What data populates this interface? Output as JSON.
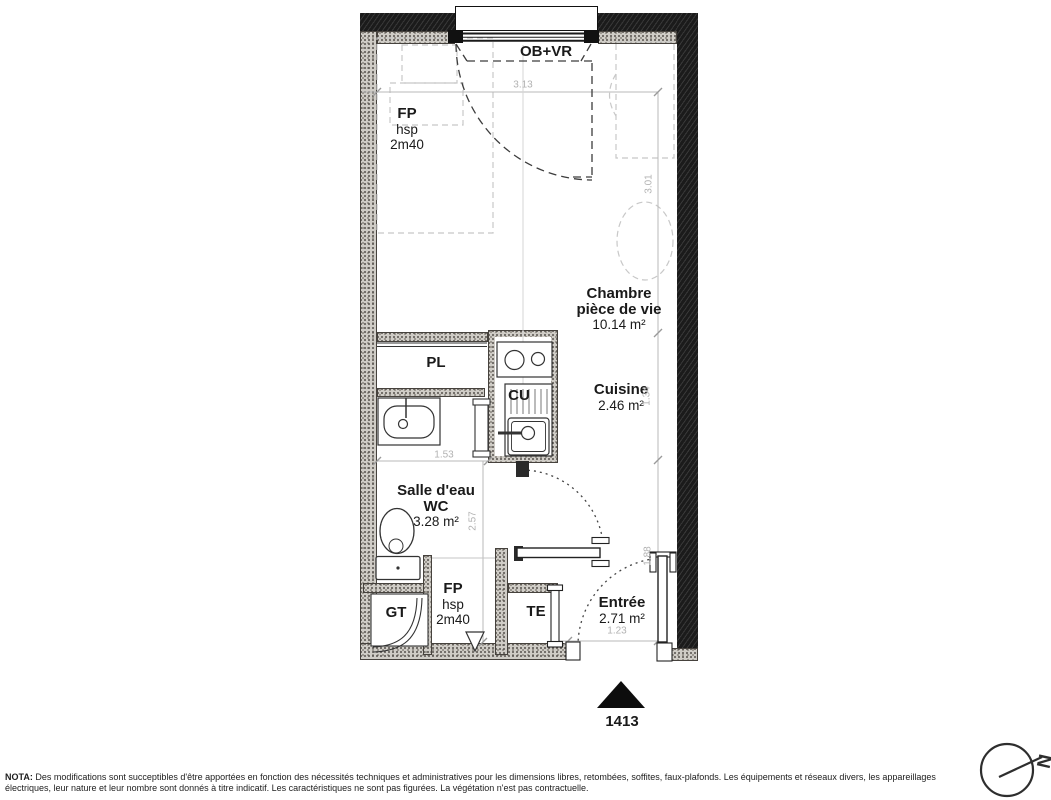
{
  "colors": {
    "wall_dark": "#1b1b1b",
    "wall_stipple": "#cfccc6",
    "dimension_gray": "#b2b2b2",
    "line_dark": "#333333"
  },
  "window": {
    "label": "OB+VR"
  },
  "ceiling_note_top": {
    "line1": "FP",
    "line2": "hsp",
    "line3": "2m40"
  },
  "ceiling_note_bottom": {
    "line1": "FP",
    "line2": "hsp",
    "line3": "2m40"
  },
  "rooms": {
    "chambre": {
      "name_line1": "Chambre",
      "name_line2": "pièce de vie",
      "area": "10.14 m²"
    },
    "cuisine": {
      "name": "Cuisine",
      "area": "2.46 m²"
    },
    "salle_eau": {
      "name_line1": "Salle d'eau",
      "name_line2": "WC",
      "area": "3.28 m²"
    },
    "entree": {
      "name": "Entrée",
      "area": "2.71 m²"
    }
  },
  "fixtures": {
    "closet": "PL",
    "kitchen_unit": "CU",
    "technical_duct": "GT",
    "electrical_panel": "TE"
  },
  "dimensions": {
    "top_width": "3.13",
    "right_upper": "3.01",
    "right_middle": "1.34",
    "right_lower": "1.88",
    "bath_width": "1.53",
    "bath_height": "2.57",
    "entry_width": "1.23"
  },
  "lot": {
    "number": "1413"
  },
  "compass": {
    "letter": "N"
  },
  "nota": {
    "label": "NOTA:",
    "text": " Des modifications sont succeptibles d'être apportées en fonction des nécessités techniques et administratives pour les dimensions libres, retombées, soffites, faux-plafonds. Les équipements et réseaux divers, les appareillages électriques, leur nature et leur nombre sont donnés à titre indicatif. Les caractéristiques ne sont pas figurées. La végétation n'est pas contractuelle."
  }
}
